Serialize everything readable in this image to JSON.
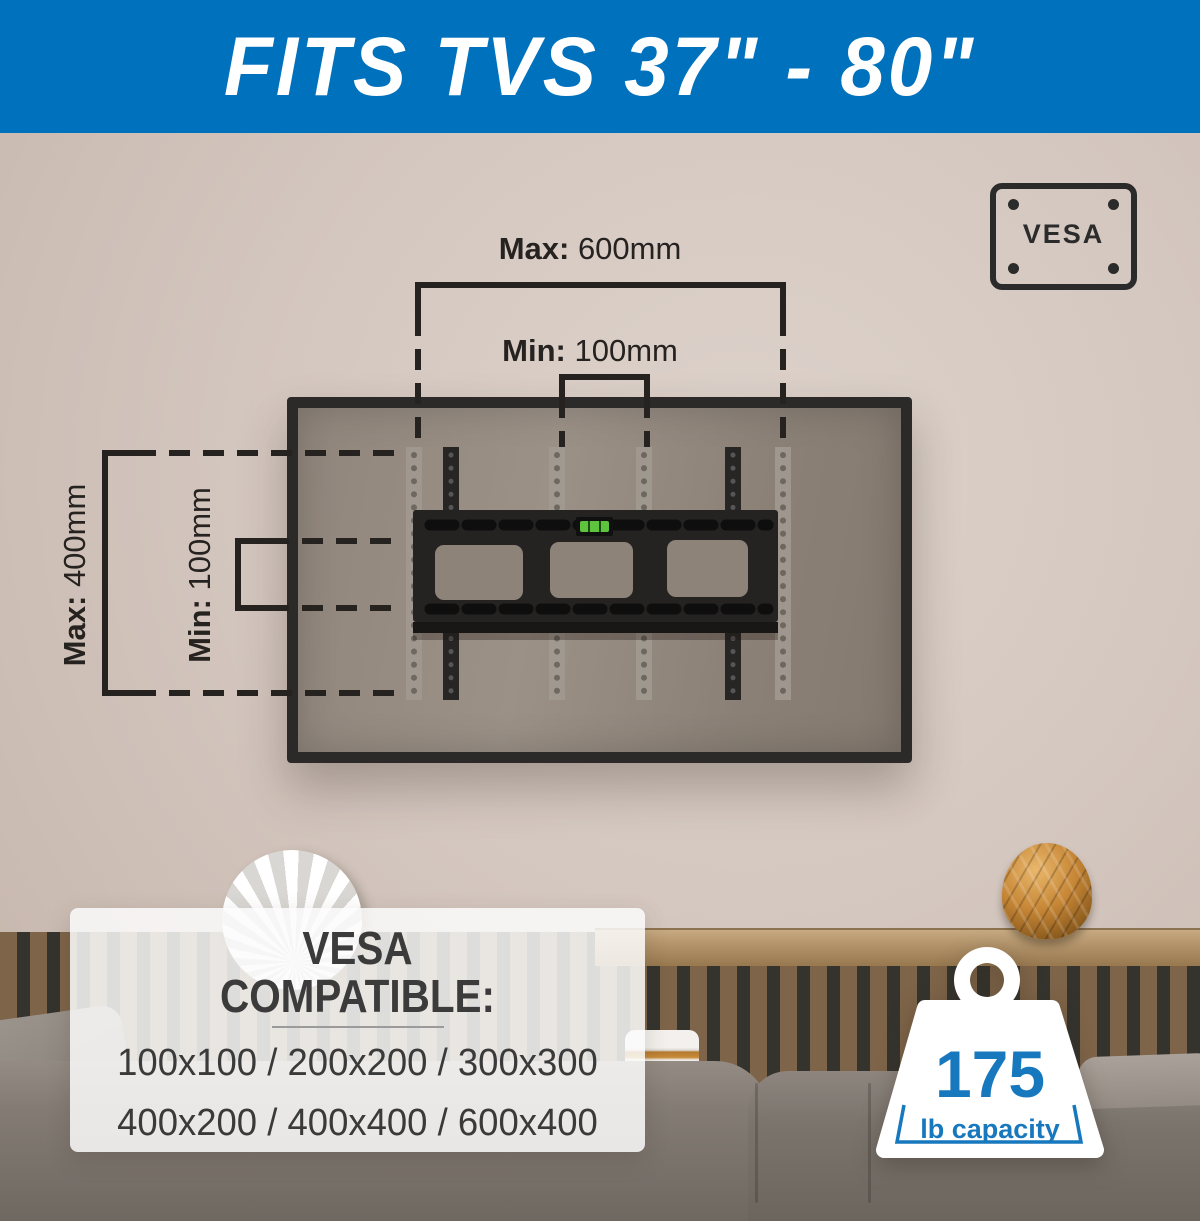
{
  "banner": {
    "title": "FITS TVS 37\" - 80\""
  },
  "vesa_badge": {
    "label": "VESA"
  },
  "measurements": {
    "top_max": {
      "label": "Max:",
      "value": " 600mm"
    },
    "top_min": {
      "label": "Min:",
      "value": " 100mm"
    },
    "left_max": {
      "label": "Max:",
      "value": " 400mm"
    },
    "left_min": {
      "label": "Min:",
      "value": " 100mm"
    }
  },
  "compatibility": {
    "heading_line1": "VESA",
    "heading_line2": "COMPATIBLE:",
    "row1": "100x100 / 200x200 / 300x300",
    "row2": "400x200 / 400x400 / 600x400"
  },
  "capacity": {
    "value": "175",
    "unit": "lb capacity"
  },
  "colors": {
    "banner_blue": "#0071bc",
    "accent_blue": "#1878be",
    "line_dark": "#262220"
  }
}
